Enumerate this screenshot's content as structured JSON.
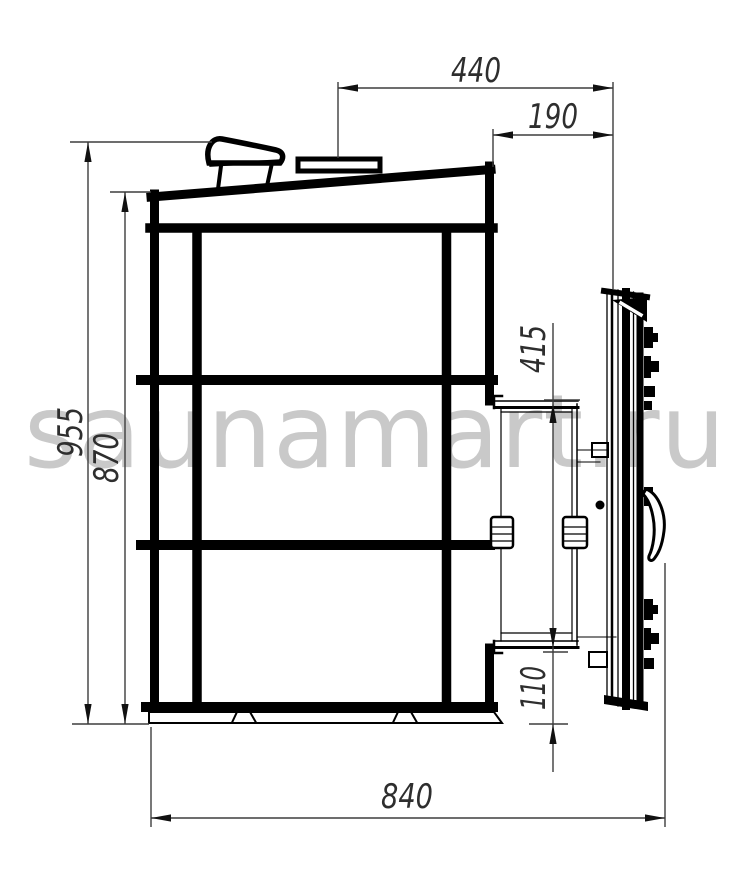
{
  "watermark": {
    "text": "saunamart.ru",
    "color": "#c9c9c9"
  },
  "drawing": {
    "stroke_color": "#000000",
    "dim_color": "#3d3d3d",
    "dimensions": {
      "top_offset": "440",
      "portal_depth": "190",
      "overall_height": "955",
      "body_height": "870",
      "portal_height": "415",
      "portal_bottom_clearance": "110",
      "overall_depth": "840"
    }
  }
}
